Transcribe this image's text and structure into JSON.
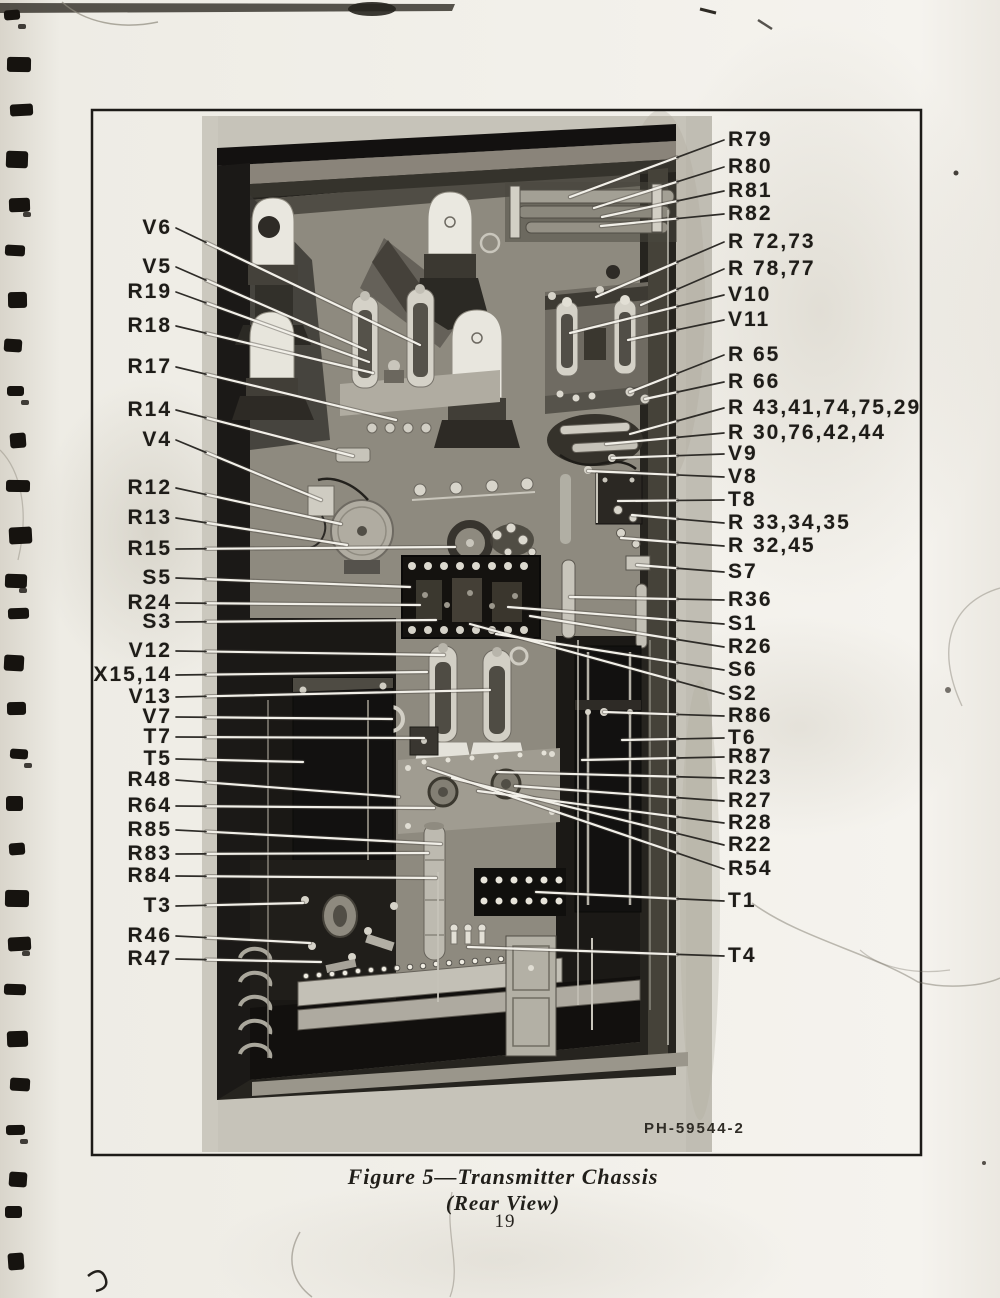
{
  "figure": {
    "photo_id": "PH-59544-2",
    "caption_title": "Figure 5—Transmitter Chassis",
    "caption_subtitle": "(Rear View)",
    "page_number": "19"
  },
  "colors": {
    "paper": "#f2f0ea",
    "ink": "#1e1c18",
    "leader_line": "#f2f0e9"
  },
  "callouts": {
    "left": [
      {
        "label": "V6",
        "y": 228,
        "tx": 420,
        "ty": 345
      },
      {
        "label": "V5",
        "y": 267,
        "tx": 366,
        "ty": 350
      },
      {
        "label": "R19",
        "y": 292,
        "tx": 369,
        "ty": 362
      },
      {
        "label": "R18",
        "y": 326,
        "tx": 373,
        "ty": 373
      },
      {
        "label": "R17",
        "y": 367,
        "tx": 396,
        "ty": 420
      },
      {
        "label": "R14",
        "y": 410,
        "tx": 353,
        "ty": 456
      },
      {
        "label": "V4",
        "y": 440,
        "tx": 321,
        "ty": 500
      },
      {
        "label": "R12",
        "y": 488,
        "tx": 341,
        "ty": 524
      },
      {
        "label": "R13",
        "y": 518,
        "tx": 347,
        "ty": 545
      },
      {
        "label": "R15",
        "y": 549,
        "tx": 455,
        "ty": 547
      },
      {
        "label": "S5",
        "y": 578,
        "tx": 410,
        "ty": 587
      },
      {
        "label": "R24",
        "y": 603,
        "tx": 420,
        "ty": 605
      },
      {
        "label": "S3",
        "y": 622,
        "tx": 436,
        "ty": 620
      },
      {
        "label": "V12",
        "y": 651,
        "tx": 444,
        "ty": 655
      },
      {
        "label": "X15,14",
        "y": 675,
        "tx": 427,
        "ty": 672
      },
      {
        "label": "V13",
        "y": 697,
        "tx": 490,
        "ty": 690
      },
      {
        "label": "V7",
        "y": 717,
        "tx": 392,
        "ty": 719
      },
      {
        "label": "T7",
        "y": 737,
        "tx": 424,
        "ty": 738
      },
      {
        "label": "T5",
        "y": 759,
        "tx": 303,
        "ty": 762
      },
      {
        "label": "R48",
        "y": 780,
        "tx": 399,
        "ty": 797
      },
      {
        "label": "R64",
        "y": 806,
        "tx": 434,
        "ty": 808
      },
      {
        "label": "R85",
        "y": 830,
        "tx": 441,
        "ty": 844
      },
      {
        "label": "R83",
        "y": 854,
        "tx": 428,
        "ty": 853
      },
      {
        "label": "R84",
        "y": 876,
        "tx": 436,
        "ty": 878
      },
      {
        "label": "T3",
        "y": 906,
        "tx": 303,
        "ty": 903
      },
      {
        "label": "R46",
        "y": 936,
        "tx": 310,
        "ty": 943
      },
      {
        "label": "R47",
        "y": 959,
        "tx": 321,
        "ty": 962
      }
    ],
    "right": [
      {
        "label": "R79",
        "y": 140,
        "tx": 570,
        "ty": 197
      },
      {
        "label": "R80",
        "y": 167,
        "tx": 594,
        "ty": 208
      },
      {
        "label": "R81",
        "y": 191,
        "tx": 602,
        "ty": 217
      },
      {
        "label": "R82",
        "y": 214,
        "tx": 601,
        "ty": 226
      },
      {
        "label": "R 72,73",
        "y": 242,
        "tx": 596,
        "ty": 297
      },
      {
        "label": "R 78,77",
        "y": 269,
        "tx": 641,
        "ty": 305
      },
      {
        "label": "V10",
        "y": 295,
        "tx": 570,
        "ty": 333
      },
      {
        "label": "V11",
        "y": 320,
        "tx": 628,
        "ty": 340
      },
      {
        "label": "R 65",
        "y": 355,
        "tx": 630,
        "ty": 392
      },
      {
        "label": "R 66",
        "y": 382,
        "tx": 645,
        "ty": 399
      },
      {
        "label": "R 43,41,74,75,29",
        "y": 408,
        "tx": 630,
        "ty": 434
      },
      {
        "label": "R 30,76,42,44",
        "y": 433,
        "tx": 606,
        "ty": 444
      },
      {
        "label": "V9",
        "y": 454,
        "tx": 612,
        "ty": 458
      },
      {
        "label": "V8",
        "y": 477,
        "tx": 588,
        "ty": 471
      },
      {
        "label": "T8",
        "y": 500,
        "tx": 618,
        "ty": 501
      },
      {
        "label": "R 33,34,35",
        "y": 523,
        "tx": 632,
        "ty": 515
      },
      {
        "label": "R 32,45",
        "y": 546,
        "tx": 621,
        "ty": 538
      },
      {
        "label": "S7",
        "y": 572,
        "tx": 637,
        "ty": 565
      },
      {
        "label": "R36",
        "y": 600,
        "tx": 570,
        "ty": 597
      },
      {
        "label": "S1",
        "y": 624,
        "tx": 508,
        "ty": 607
      },
      {
        "label": "R26",
        "y": 647,
        "tx": 530,
        "ty": 616
      },
      {
        "label": "S6",
        "y": 670,
        "tx": 496,
        "ty": 634
      },
      {
        "label": "S2",
        "y": 694,
        "tx": 470,
        "ty": 624
      },
      {
        "label": "R86",
        "y": 716,
        "tx": 604,
        "ty": 712
      },
      {
        "label": "T6",
        "y": 738,
        "tx": 622,
        "ty": 740
      },
      {
        "label": "R87",
        "y": 757,
        "tx": 582,
        "ty": 760
      },
      {
        "label": "R23",
        "y": 778,
        "tx": 497,
        "ty": 772
      },
      {
        "label": "R27",
        "y": 801,
        "tx": 515,
        "ty": 786
      },
      {
        "label": "R28",
        "y": 823,
        "tx": 478,
        "ty": 791
      },
      {
        "label": "R22",
        "y": 845,
        "tx": 452,
        "ty": 778
      },
      {
        "label": "R54",
        "y": 869,
        "tx": 428,
        "ty": 768
      },
      {
        "label": "T1",
        "y": 901,
        "tx": 536,
        "ty": 892
      },
      {
        "label": "T4",
        "y": 956,
        "tx": 468,
        "ty": 947
      }
    ]
  }
}
